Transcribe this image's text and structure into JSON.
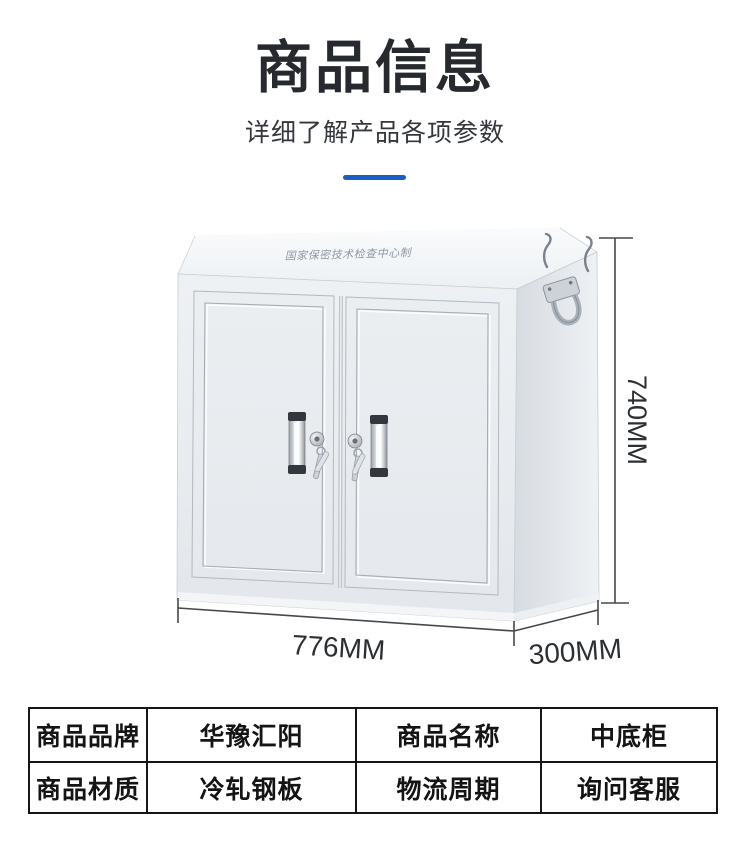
{
  "header": {
    "title": "商品信息",
    "subtitle": "详细了解产品各项参数"
  },
  "product": {
    "engraving_text": "国家保密技术检查中心制",
    "dimension_height": "740MM",
    "dimension_width": "776MM",
    "dimension_depth": "300MM"
  },
  "spec_table": {
    "rows": [
      {
        "cells": [
          "商品品牌",
          "华豫汇阳",
          "商品名称",
          "中底柜"
        ]
      },
      {
        "cells": [
          "商品材质",
          "冷轧钢板",
          "物流周期",
          "询问客服"
        ]
      }
    ]
  },
  "colors": {
    "accent_divider": "#1b5fc6",
    "title_text": "#26292e",
    "subtitle_text": "#34373c",
    "table_border": "#161616",
    "cabinet_body": "#e9edf0",
    "cabinet_side": "#dde2e7",
    "dimension_ink": "#2c2f33"
  }
}
